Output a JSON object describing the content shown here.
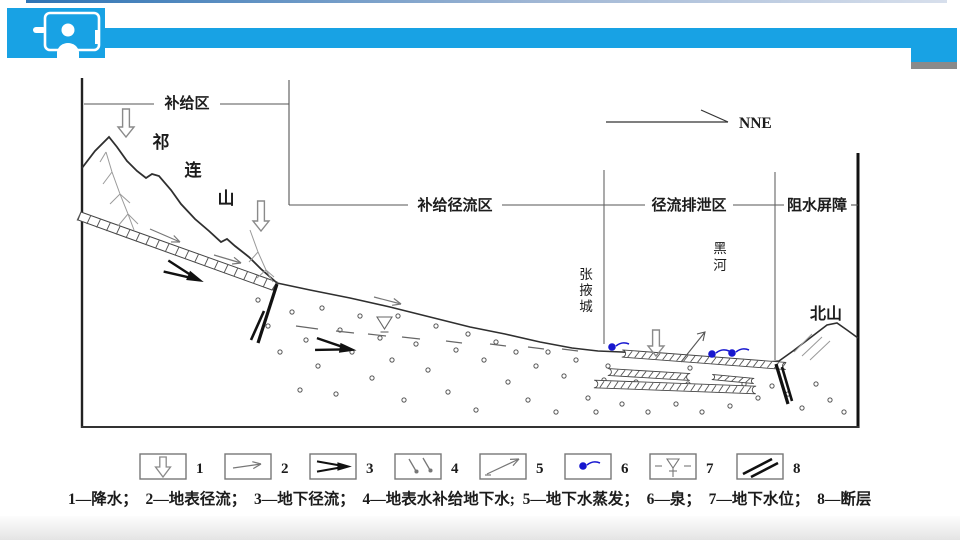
{
  "header": {
    "icon": "presenter-icon"
  },
  "diagram": {
    "compass": "NNE",
    "zones": {
      "recharge": "补给区",
      "recharge_runoff": "补给径流区",
      "runoff_discharge": "径流排泄区",
      "water_barrier": "阻水屏障"
    },
    "places": {
      "qilian_chars": [
        "祁",
        "连",
        "山"
      ],
      "zhangye_chars": [
        "张",
        "掖",
        "城"
      ],
      "heihe_chars": [
        "黑",
        "河"
      ],
      "beishan": "北山"
    }
  },
  "legend": {
    "numbers": [
      "1",
      "2",
      "3",
      "4",
      "5",
      "6",
      "7",
      "8"
    ],
    "caption": "1—降水；  2—地表径流；  3—地下径流；  4—地表水补给地下水;  5—地下水蒸发；  6—泉；  7—地下水位；  8—断层"
  },
  "colors": {
    "accent": "#18a2e4",
    "spring_blue": "#1717cf",
    "line": "#3c3c3c",
    "step_gray": "#8a8a8a"
  }
}
